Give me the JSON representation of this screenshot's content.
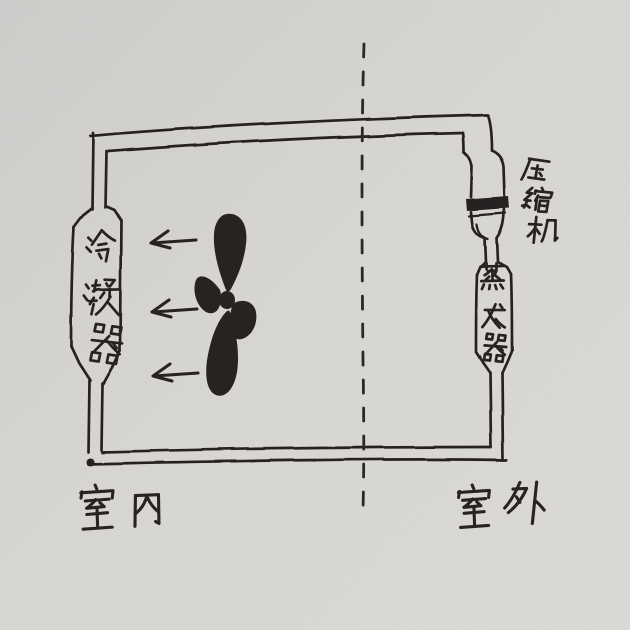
{
  "scene": {
    "title": "Hand-drawn sketch of an air-conditioner refrigeration cycle",
    "medium": "ink on paper",
    "paper_color": "#d7d5d2",
    "ink_color": "#262320"
  },
  "diagram": {
    "indoor": {
      "region_label": "室内",
      "condenser_label": "冷凝器",
      "fan": {
        "icon": "fan-propeller-icon",
        "blade_count": 4
      },
      "airflow": {
        "direction": "left",
        "arrow_count": 3
      }
    },
    "outdoor": {
      "region_label": "室外",
      "compressor_label": "压缩机",
      "evaporator_label": "蒸发器"
    },
    "divider": {
      "style": "dashed",
      "orientation": "vertical"
    }
  }
}
